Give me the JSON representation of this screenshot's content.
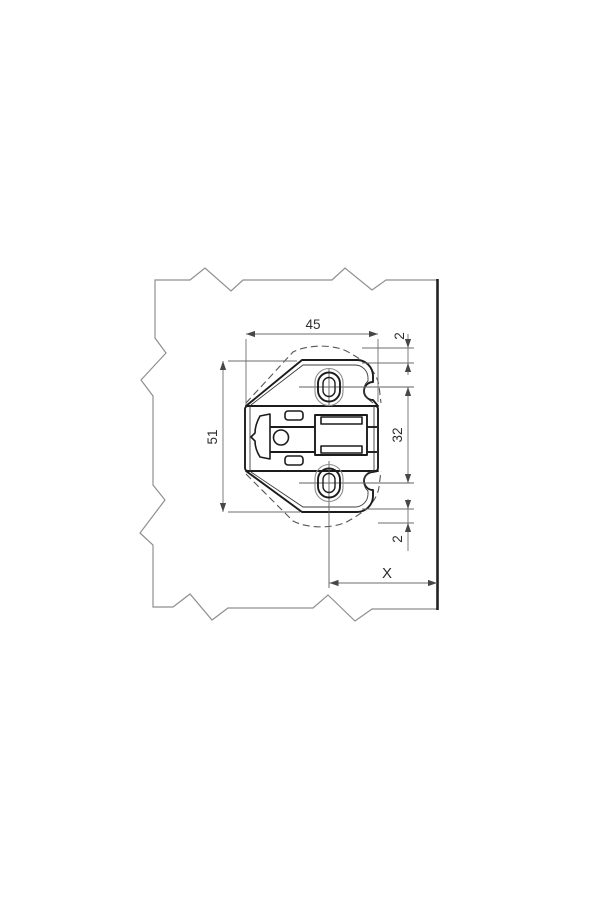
{
  "page": {
    "background": "#ffffff"
  },
  "drawing": {
    "description": "Dimensioned technical drawing of a hinge cross mounting plate shown on a cabinet panel with break lines",
    "units": "mm",
    "colors": {
      "plate_line": "#1c1c1c",
      "panel_break_line": "#8f8f8f",
      "panel_front_edge": "#222222",
      "dimension_line": "#6e6e6e",
      "dimension_text": "#2d2d2d",
      "background": "#ffffff"
    },
    "dimensions": {
      "plate_width": {
        "label": "45"
      },
      "top_offset": {
        "label": "2"
      },
      "plate_height": {
        "label": "51"
      },
      "screw_hole_spacing": {
        "label": "32"
      },
      "bottom_offset": {
        "label": "2"
      },
      "edge_distance": {
        "label": "X"
      }
    }
  }
}
